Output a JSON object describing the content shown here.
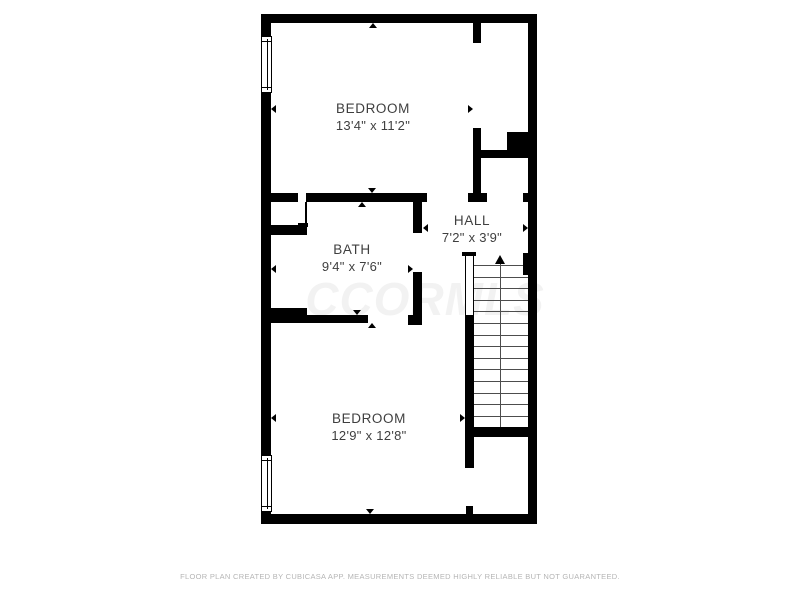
{
  "floor_plan": {
    "colors": {
      "background": "#ffffff",
      "wall": "#000000",
      "label": "#3f3f3f",
      "tread": "#4d4d4d",
      "footer": "#b5b5b5",
      "watermark": "rgba(0,0,0,0.05)"
    },
    "watermark": "CCORMLS",
    "rooms": [
      {
        "name": "BEDROOM",
        "dimensions": "13'4\" x 11'2\""
      },
      {
        "name": "BATH",
        "dimensions": "9'4\" x 7'6\""
      },
      {
        "name": "HALL",
        "dimensions": "7'2\" x 3'9\""
      },
      {
        "name": "BEDROOM",
        "dimensions": "12'9\" x 12'8\""
      }
    ],
    "stairs": {
      "treads": 14,
      "direction": "up"
    },
    "footer": "FLOOR PLAN CREATED BY CUBICASA APP. MEASUREMENTS DEEMED HIGHLY RELIABLE BUT NOT GUARANTEED."
  }
}
